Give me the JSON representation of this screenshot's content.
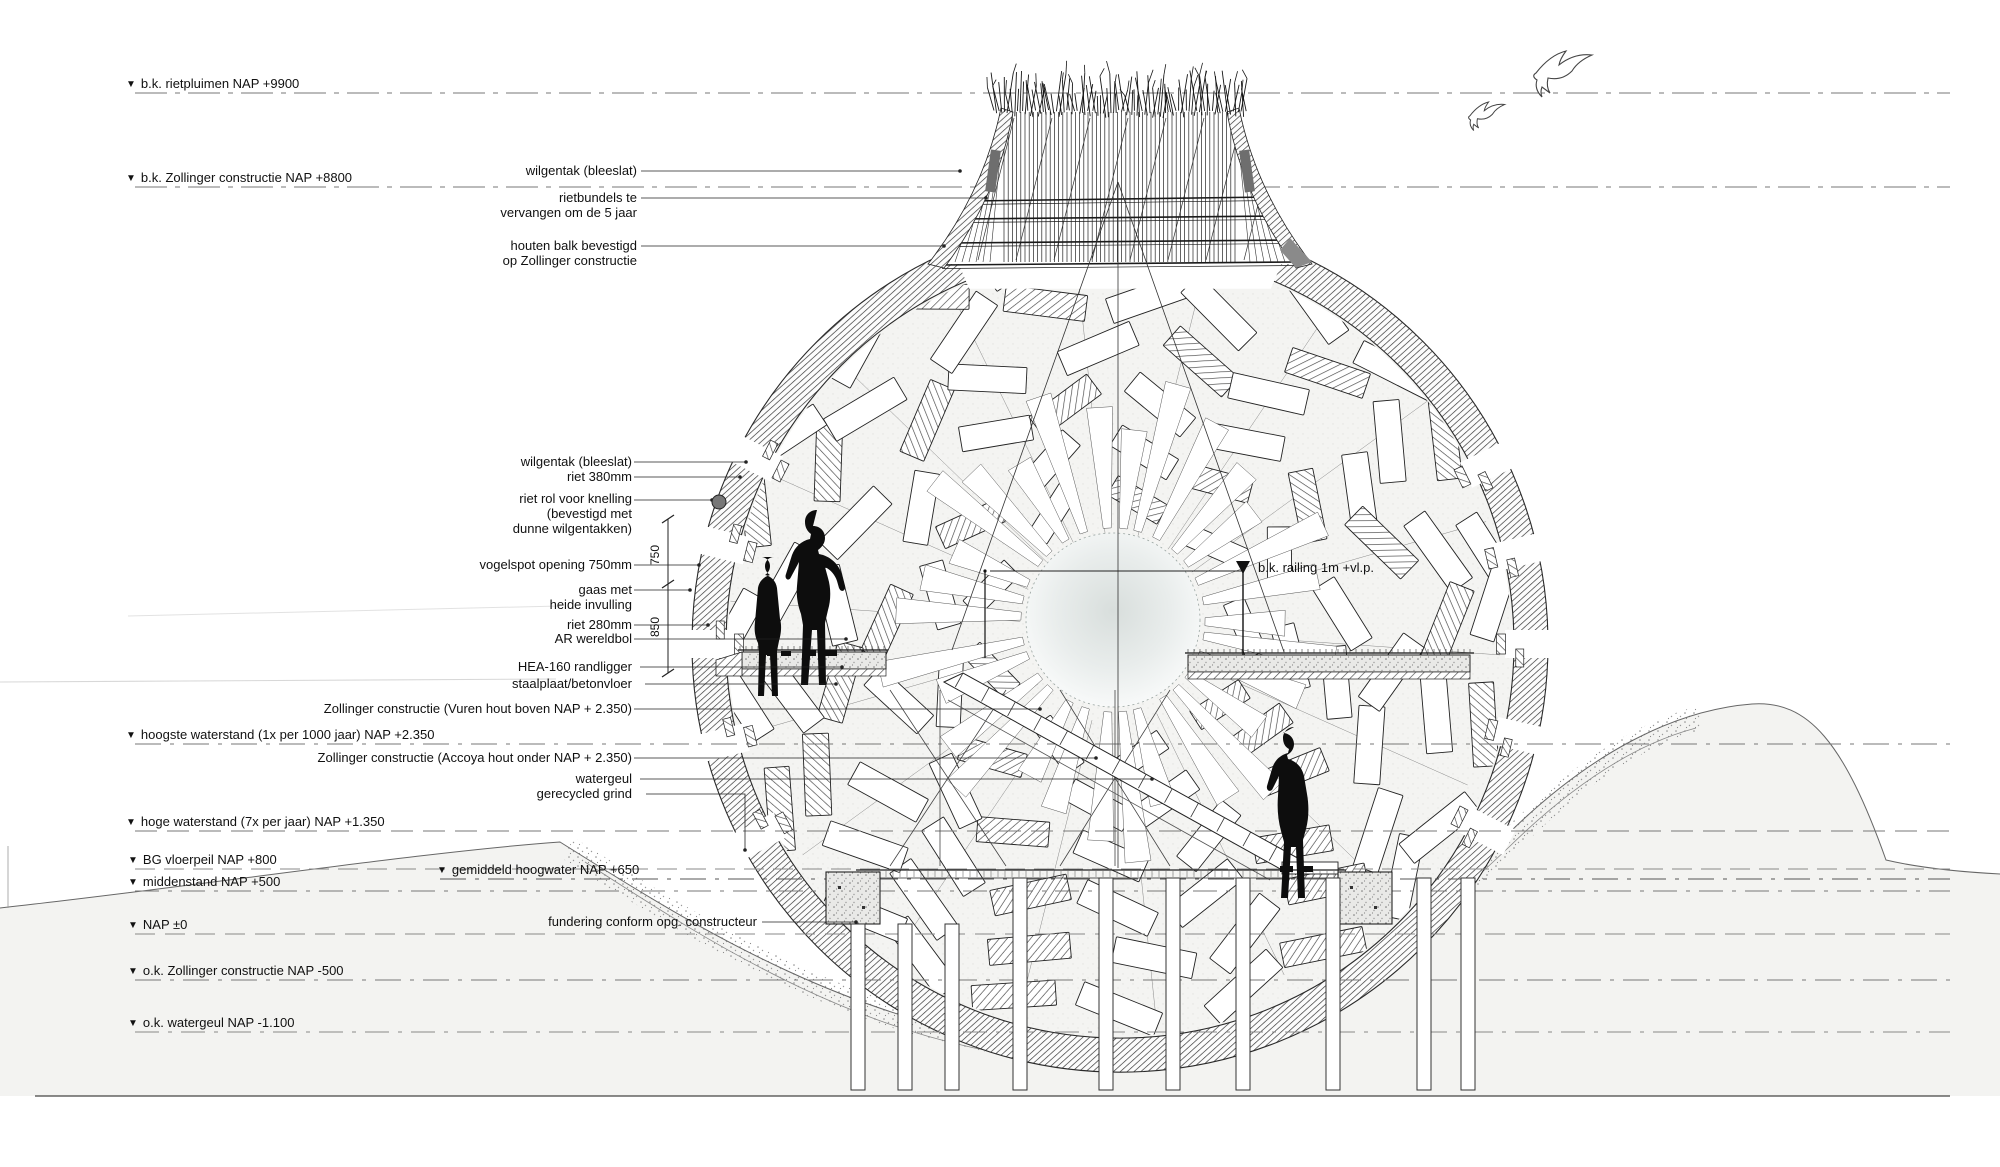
{
  "glyphs": {
    "level_marker": "▼"
  },
  "colors": {
    "ink": "#1a1a1a",
    "paper": "#ffffff",
    "terrain_tint": "#f3f3f1"
  },
  "datum_labels": {
    "rietpluimen": "b.k. rietpluimen NAP +9900",
    "zollinger_bk": "b.k. Zollinger constructie NAP +8800",
    "hoogste_waterstand": "hoogste waterstand (1x per 1000 jaar) NAP +2.350",
    "hoge_waterstand": "hoge waterstand (7x per jaar) NAP +1.350",
    "bg_vloerpeil": "BG vloerpeil NAP +800",
    "gemiddeld_hoogwater": "gemiddeld hoogwater NAP +650",
    "middenstand": "middenstand NAP +500",
    "nap_nul": "NAP ±0",
    "zollinger_ok": "o.k. Zollinger constructie NAP -500",
    "watergeul_ok": "o.k. watergeul NAP -1.100"
  },
  "callouts_top": {
    "wilgentak": "wilgentak (bleeslat)",
    "rietbundels_r1": "rietbundels te",
    "rietbundels_r2": "vervangen om de 5 jaar",
    "houten_balk_r1": "houten balk bevestigd",
    "houten_balk_r2": "op Zollinger constructie"
  },
  "callouts_mid": {
    "wilgentak": "wilgentak (bleeslat)",
    "riet_380": "riet 380mm",
    "riet_rol_r1": "riet rol voor knelling",
    "riet_rol_r2": "(bevestigd met",
    "riet_rol_r3": "dunne wilgentakken)",
    "vogelspot": "vogelspot opening 750mm",
    "gaas_r1": "gaas met",
    "gaas_r2": "heide invulling",
    "riet_280": "riet 280mm",
    "ar_wereldbol": "AR wereldbol",
    "hea": "HEA-160 randligger",
    "staalplaat": "staalplaat/betonvloer",
    "zollinger_vuren": "Zollinger constructie (Vuren hout boven NAP + 2.350)",
    "zollinger_accoya": "Zollinger constructie (Accoya hout onder NAP + 2.350)",
    "watergeul": "watergeul",
    "grind": "gerecycled grind",
    "fundering": "fundering conform opg. constructeur"
  },
  "right_label": {
    "text": "b.k. railing 1m +vl.p."
  },
  "dimensions": {
    "upper": "750",
    "lower": "850"
  }
}
